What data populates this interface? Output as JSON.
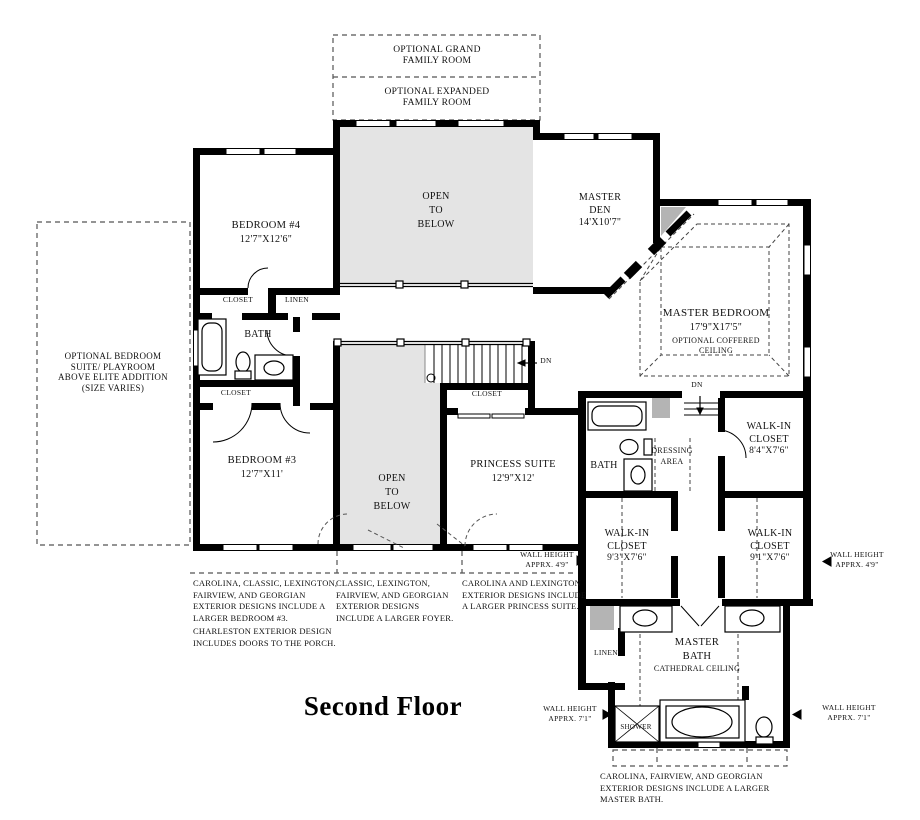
{
  "title": "Second Floor",
  "colors": {
    "wall": "#000000",
    "background": "#ffffff",
    "open_to_below_fill": "#e4e4e4",
    "shade_gray": "#b4b4b4"
  },
  "optional_areas": {
    "grand_family_room": "OPTIONAL GRAND\nFAMILY ROOM",
    "expanded_family_room": "OPTIONAL EXPANDED\nFAMILY ROOM",
    "bedroom_suite_playroom": "OPTIONAL BEDROOM\nSUITE/ PLAYROOM\nABOVE ELITE ADDITION\n(SIZE VARIES)"
  },
  "rooms": {
    "bedroom_4": {
      "name": "BEDROOM #4",
      "dims": "12'7\"X12'6\""
    },
    "bedroom_3": {
      "name": "BEDROOM #3",
      "dims": "12'7\"X11'"
    },
    "open_to_below_upper": "OPEN\nTO\nBELOW",
    "open_to_below_lower": "OPEN\nTO\nBELOW",
    "master_den": {
      "name": "MASTER\nDEN",
      "dims": "14'X10'7\""
    },
    "master_bedroom": {
      "name": "MASTER BEDROOM",
      "dims": "17'9\"X17'5\"",
      "option": "OPTIONAL COFFERED\nCEILING"
    },
    "princess_suite": {
      "name": "PRINCESS SUITE",
      "dims": "12'9\"X12'"
    },
    "hall_bath": "BATH",
    "master_hall_bath": "BATH",
    "dressing_area": "DRESSING\nAREA",
    "walk_in_closet_a": {
      "name": "WALK-IN\nCLOSET",
      "dims": "8'4\"X7'6\""
    },
    "walk_in_closet_b": {
      "name": "WALK-IN\nCLOSET",
      "dims": "9'3\"X7'6\""
    },
    "walk_in_closet_c": {
      "name": "WALK-IN\nCLOSET",
      "dims": "9'1\"X7'6\""
    },
    "master_bath": {
      "name": "MASTER\nBATH",
      "ceiling": "CATHEDRAL CEILING"
    },
    "shower": "SHOWER"
  },
  "labels": {
    "closet_bedroom4": "CLOSET",
    "linen_hall": "LINEN",
    "closet_hall": "CLOSET",
    "closet_stairs": "CLOSET",
    "linen_master": "LINEN",
    "down_stairs": "DN",
    "down_master": "DN"
  },
  "wall_heights": {
    "half_wall": "WALL HEIGHT\nAPPRX. 4'9\"",
    "knee_wall": "WALL HEIGHT\nAPPRX. 7'1\""
  },
  "notes": {
    "bedroom3": "CAROLINA, CLASSIC, LEXINGTON,\nFAIRVIEW, AND GEORGIAN\nEXTERIOR DESIGNS INCLUDE A\nLARGER BEDROOM #3.",
    "charleston": "CHARLESTON EXTERIOR DESIGN\nINCLUDES DOORS TO THE PORCH.",
    "foyer": "CLASSIC, LEXINGTON,\nFAIRVIEW, AND GEORGIAN\nEXTERIOR DESIGNS\nINCLUDE A LARGER FOYER.",
    "princess": "CAROLINA AND LEXINGTON\nEXTERIOR DESIGNS INCLUDE\nA LARGER PRINCESS SUITE.",
    "master_bath": "CAROLINA, FAIRVIEW, AND GEORGIAN\nEXTERIOR DESIGNS INCLUDE A LARGER\nMASTER BATH."
  }
}
